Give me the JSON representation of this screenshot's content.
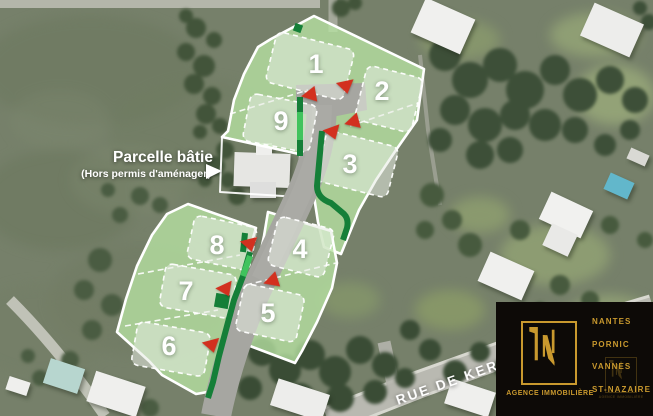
{
  "map": {
    "street_label": "RUE DE KER",
    "annotation": {
      "title": "Parcelle bâtie",
      "subtitle": "(Hors permis d'aménager)"
    }
  },
  "plan": {
    "lots": [
      {
        "n": "1",
        "x": 316,
        "y": 63,
        "zone": [
          310,
          66,
          80,
          52,
          14
        ],
        "marker": [
          346,
          87,
          "down",
          -12
        ]
      },
      {
        "n": "2",
        "x": 382,
        "y": 90,
        "zone": [
          389,
          99,
          58,
          56,
          14
        ],
        "marker": [
          352,
          122,
          "left",
          -15
        ]
      },
      {
        "n": "3",
        "x": 350,
        "y": 163,
        "zone": [
          357,
          164,
          74,
          52,
          14
        ],
        "marker": [
          333,
          133,
          "down",
          -20
        ]
      },
      {
        "n": "9",
        "x": 281,
        "y": 120,
        "zone": [
          280,
          123,
          68,
          48,
          11
        ],
        "marker": [
          309,
          95,
          "left",
          -10
        ]
      },
      {
        "n": "8",
        "x": 217,
        "y": 244,
        "zone": [
          222,
          243,
          64,
          44,
          12
        ],
        "marker": [
          250,
          245,
          "down",
          -14
        ]
      },
      {
        "n": "4",
        "x": 300,
        "y": 248,
        "zone": [
          301,
          247,
          58,
          50,
          14
        ],
        "marker": null
      },
      {
        "n": "7",
        "x": 186,
        "y": 290,
        "zone": [
          198,
          291,
          72,
          44,
          10
        ],
        "marker": [
          226,
          290,
          "down",
          -25
        ]
      },
      {
        "n": "5",
        "x": 268,
        "y": 312,
        "zone": [
          270,
          313,
          62,
          48,
          12
        ],
        "marker": [
          271,
          281,
          "left",
          -18
        ]
      },
      {
        "n": "6",
        "x": 169,
        "y": 345,
        "zone": [
          171,
          349,
          74,
          44,
          10
        ],
        "marker": [
          212,
          346,
          "down",
          -15
        ]
      }
    ]
  },
  "logo": {
    "monogram": "LN",
    "tagline": "AGENCE IMMOBILIÈRE",
    "cities": [
      "NANTES",
      "PORNIC",
      "VANNES",
      "ST-NAZAIRE"
    ]
  },
  "theme": {
    "c-overlay": "#b7e3a3",
    "c-zone": "#e6ebe1",
    "c-hedge-dark": "#157f38",
    "c-hedge-bright": "#41c35d",
    "c-marker": "#d2301f",
    "c-gold": "#c9992e",
    "c-logo-bg": "#0d0a07"
  }
}
